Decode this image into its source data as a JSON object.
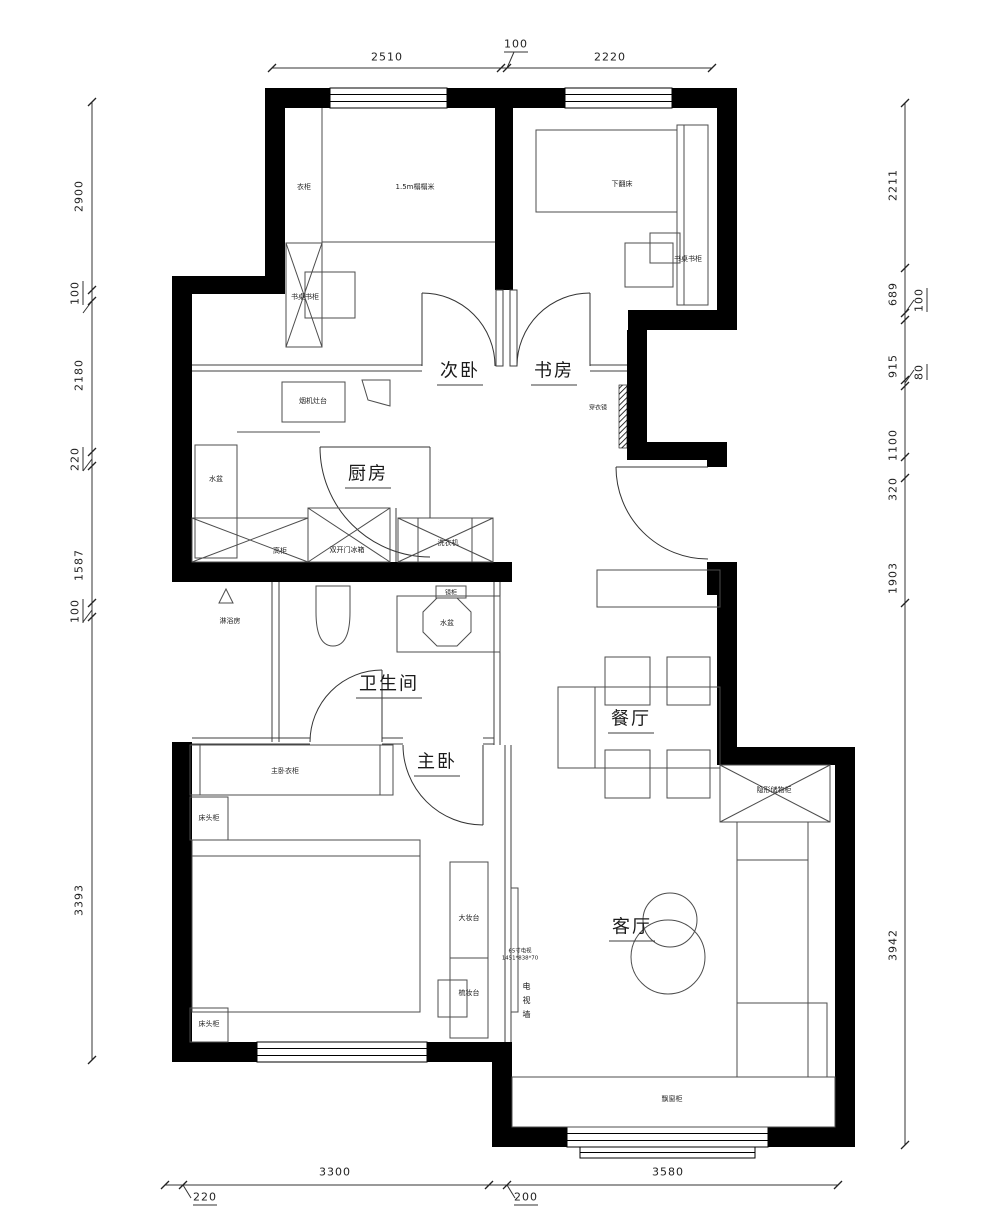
{
  "rooms": {
    "bedroom2": "次卧",
    "study": "书房",
    "kitchen": "厨房",
    "bathroom": "卫生间",
    "master_bedroom": "主卧",
    "dining": "餐厅",
    "living": "客厅"
  },
  "furniture": {
    "wardrobe": "衣柜",
    "tatami": "1.5m榻榻米",
    "desk_bookcase": "书桌书柜",
    "folding_bed": "下翻床",
    "dressing_mirror": "穿衣镜",
    "stove_counter": "烟机灶台",
    "kitchen_sink": "水盆",
    "tall_cabinet": "高柜",
    "fridge": "双开门冰箱",
    "washer": "洗衣机",
    "shower_room": "淋浴房",
    "mirror_cabinet": "镜柜",
    "bath_sink": "水盆",
    "master_wardrobe": "主卧衣柜",
    "nightstand": "床头柜",
    "vanity_large": "大妆台",
    "vanity": "梳妆台",
    "tv_wall": "电视墙",
    "tv_spec_line1": "65寸电视",
    "tv_spec_line2": "1451*838*70",
    "hidden_storage": "隐形储物柜",
    "bay_window_cabinet": "飘窗柜"
  },
  "dimensions": {
    "top": [
      "2510",
      "100",
      "2220"
    ],
    "left": [
      "2900",
      "100",
      "2180",
      "220",
      "1587",
      "100",
      "3393"
    ],
    "right": [
      "2211",
      "689",
      "100",
      "915",
      "80",
      "1100",
      "320",
      "1903",
      "3942"
    ],
    "bottom": [
      "220",
      "3300",
      "200",
      "3580"
    ]
  },
  "colors": {
    "wall": "#000000",
    "thin_line": "#3f3f3f",
    "text": "#1a1a1a",
    "background": "#ffffff"
  }
}
